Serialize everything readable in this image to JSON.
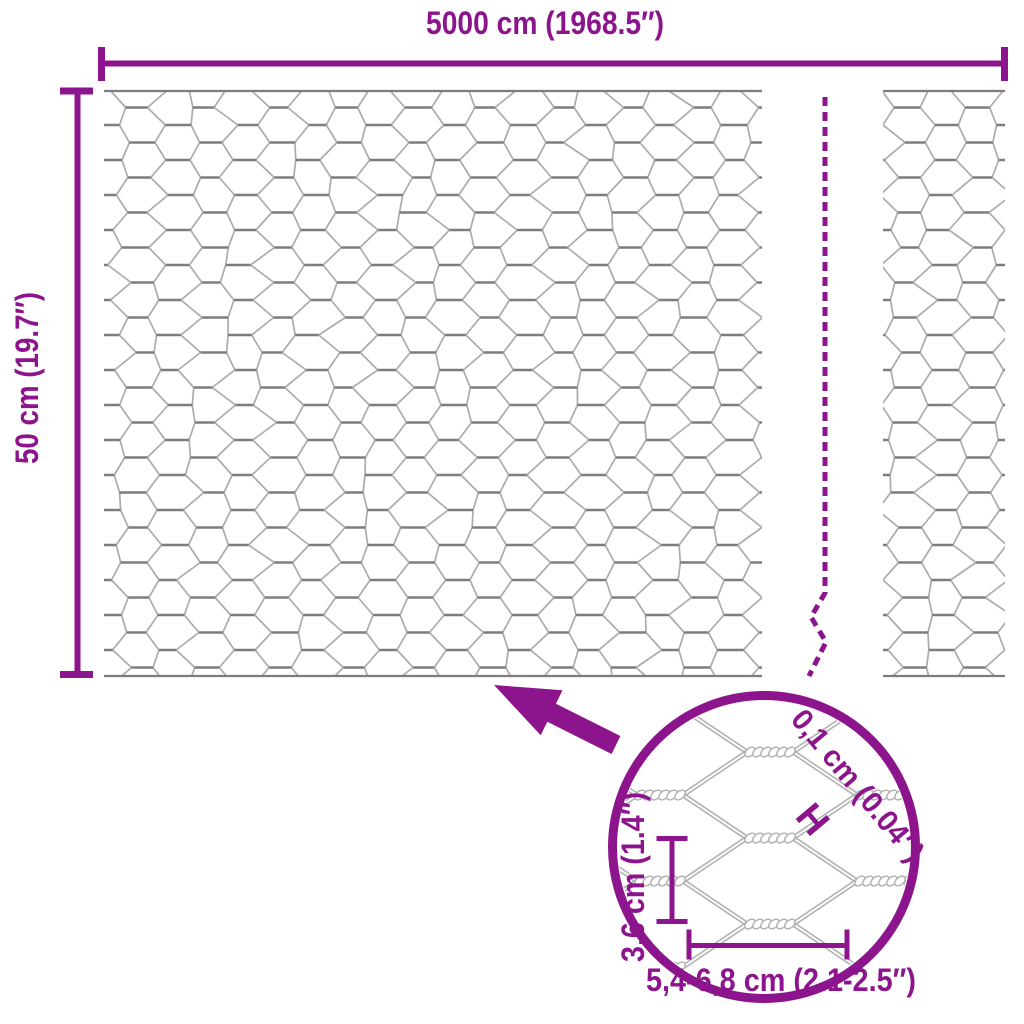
{
  "product_diagram": {
    "type": "hexagonal-wire-mesh-roll",
    "roll": {
      "width_label": "5000 cm (1968.5″)",
      "height_label": "50 cm (19.7″)"
    },
    "detail_view": {
      "wire_thickness_label": "0,1 cm (0.04″)",
      "wire_thickness_symbol": "H",
      "mesh_height_label": "3,6 cm (1.4″)",
      "mesh_width_label": "5,4-6,8 cm (2.1-2.5″)"
    },
    "icons": {
      "arrow": "zoom-callout-arrow",
      "break_line": "roll-length-break-dashed-line",
      "lens": "magnifier-detail-circle"
    },
    "colors": {
      "accent": "#8C148C",
      "wire": "#ABABAB",
      "wire_dark": "#7D7D7D",
      "detail_wire": "#B3B3B3",
      "background": "#FFFFFF"
    }
  }
}
